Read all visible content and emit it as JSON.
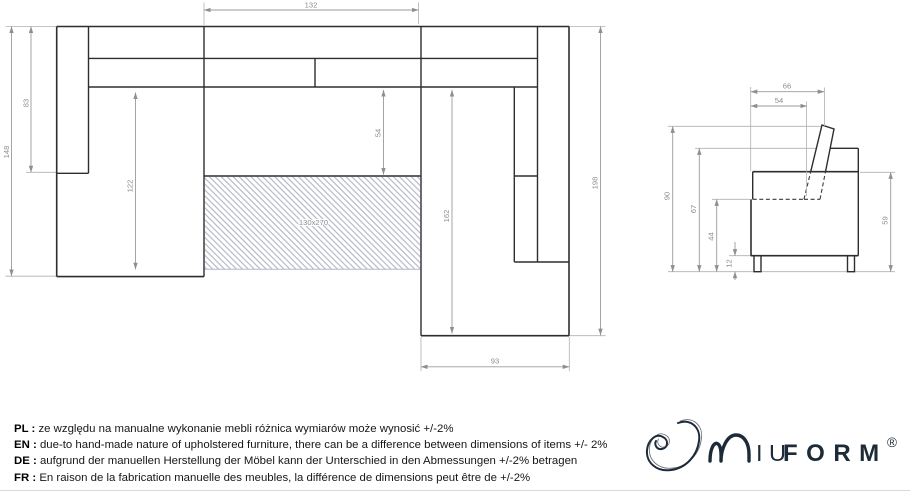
{
  "colors": {
    "drawing_line": "#2e2e2e",
    "dimension_line": "#9a9a9a",
    "dimension_text": "#8c8c8c",
    "hatch": "#a8adbd",
    "brand_navy": "#1d2b38"
  },
  "top_view": {
    "sleeping_area_label": "130x270",
    "dims": {
      "top_width": "132",
      "left_total_height": "148",
      "left_arm_length": "83",
      "left_seat_depth": "122",
      "mid_seat_depth": "54",
      "chaise_inner_length": "162",
      "right_total_height": "198",
      "chaise_width": "93"
    }
  },
  "side_view": {
    "dims": {
      "top_depth": "66",
      "seat_depth_top": "54",
      "total_height": "90",
      "back_height": "67",
      "seat_height": "44",
      "leg_height": "12",
      "side_height": "59"
    }
  },
  "footer": {
    "notes": [
      {
        "label": "PL :",
        "text": "ze względu na manualne wykonanie mebli różnica wymiarów może wynosić +/-2%"
      },
      {
        "label": "EN :",
        "text": "due-to hand-made nature of upholstered furniture, there can be a difference between dimensions of items +/- 2%"
      },
      {
        "label": "DE :",
        "text": "aufgrund der manuellen Herstellung der Möbel kann der Unterschied in den Abmessungen +/-2% betragen"
      },
      {
        "label": "FR :",
        "text": "En raison de la fabrication manuelle des meubles, la différence de dimensions peut être de +/-2%"
      }
    ]
  },
  "logo": {
    "brand": "MIUFORM",
    "iu": "IU",
    "form": "FORM",
    "registered": "®"
  }
}
